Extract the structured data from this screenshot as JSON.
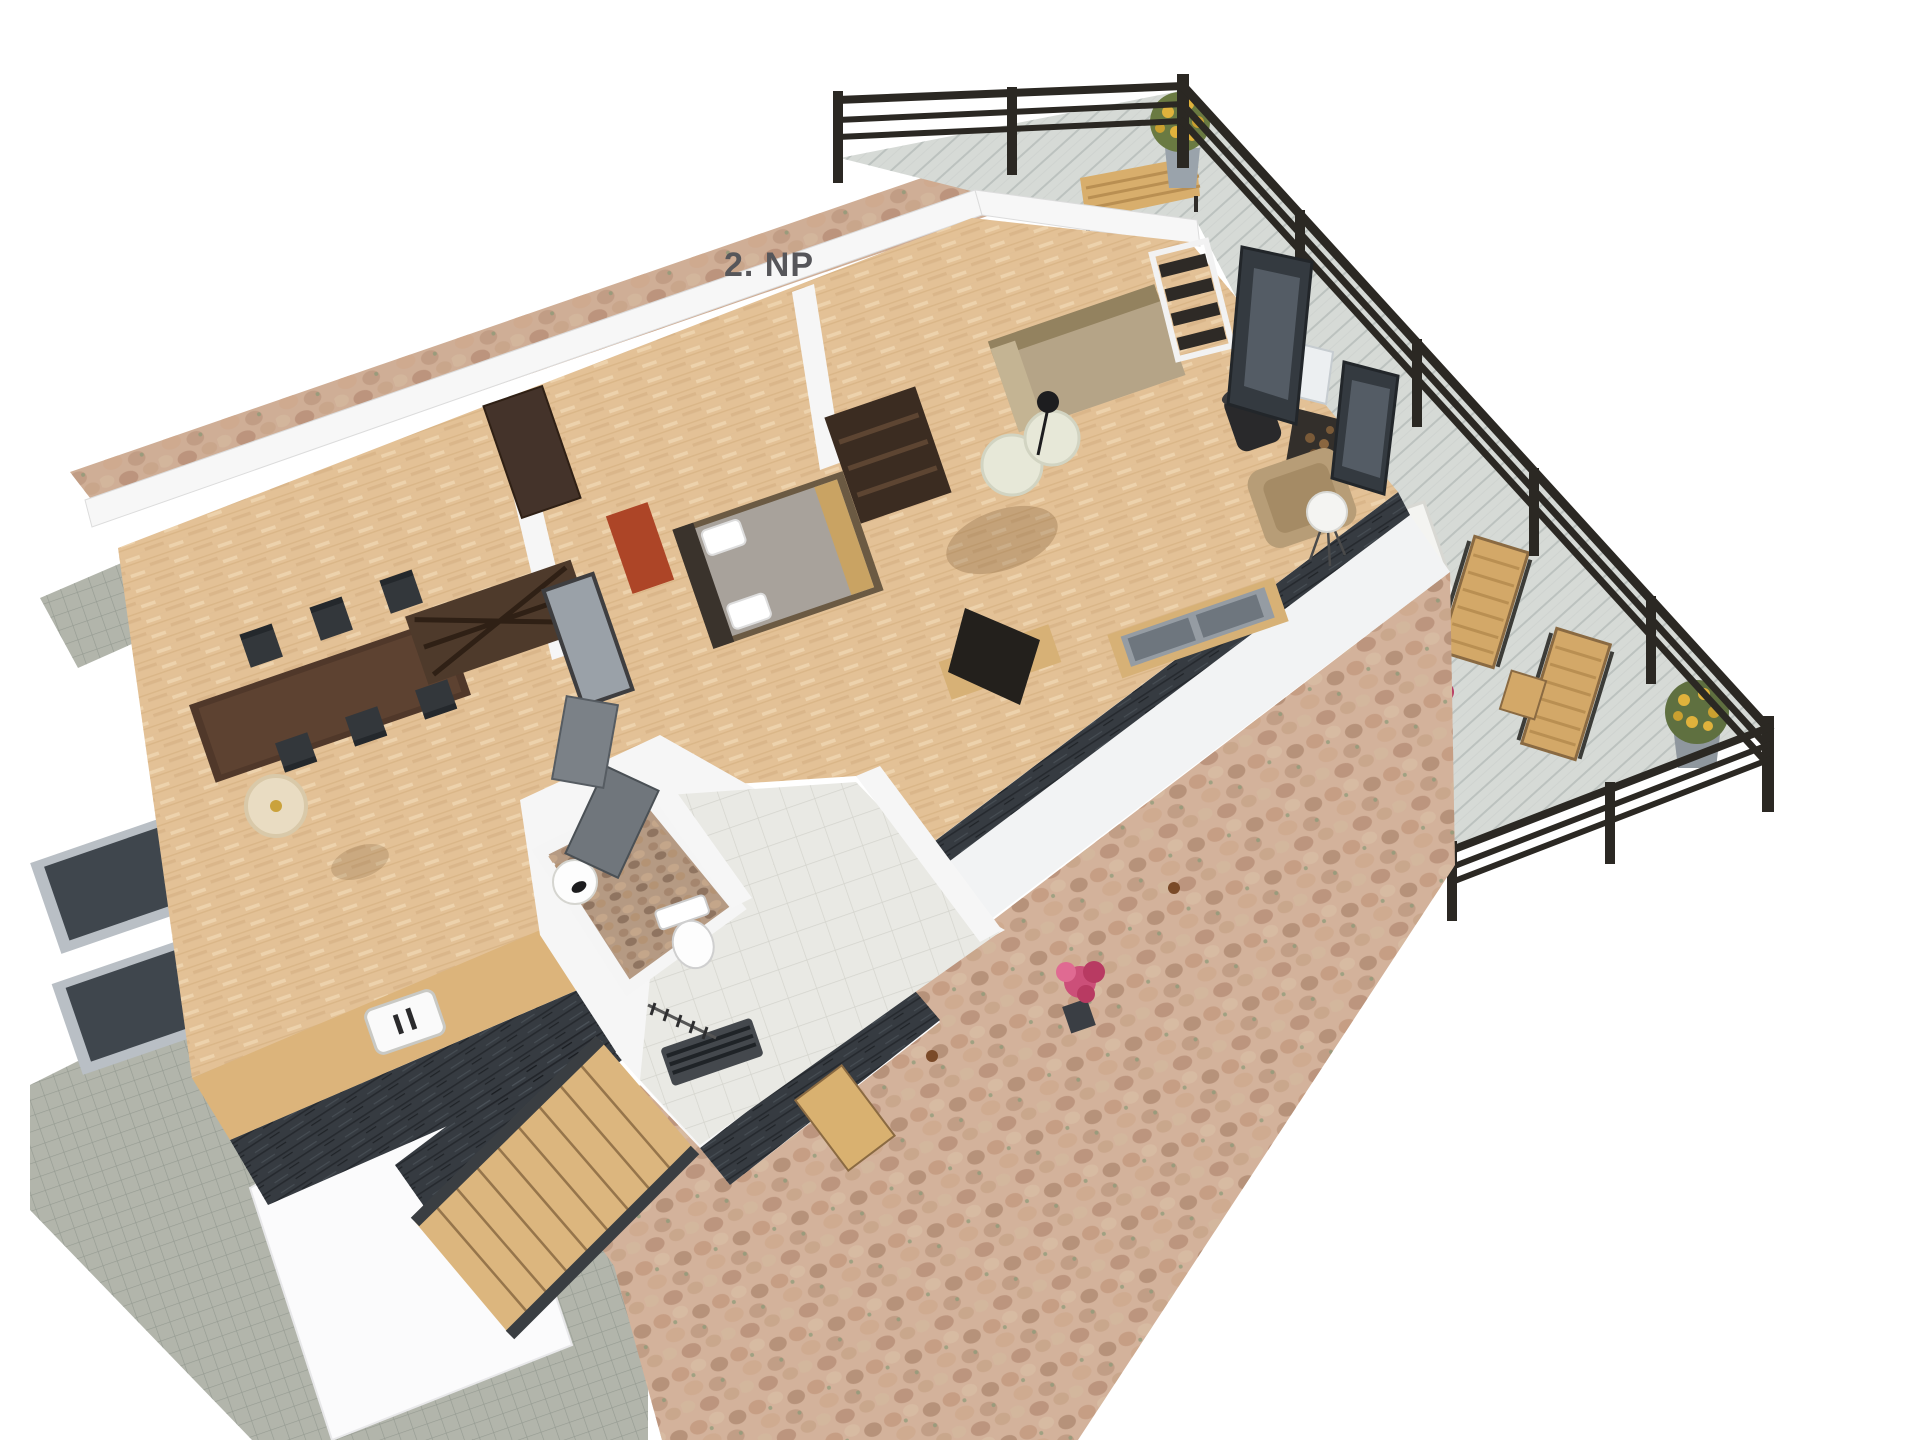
{
  "floor_plan": {
    "label": "2. NP",
    "view": "3d-top-down-render",
    "rooms": [
      "dining-room",
      "bedroom",
      "living-room",
      "bathroom",
      "hallway",
      "staircase",
      "terrace",
      "deck"
    ]
  },
  "colors": {
    "background": "#ffffff",
    "parquet": "#e3c196",
    "deck": "#d6dad6",
    "stone_patio": "#d3b29b",
    "stone_path": "#cfae96",
    "pavers": "#b2b5ab",
    "dark_wall": "#363b41",
    "white_wall": "#f7f7f7",
    "tile_floor": "#e9e9e4",
    "mosaic_floor": "#b59a83",
    "railing": "#2b2823",
    "wood_light": "#d7b176",
    "wood_dark": "#46342a",
    "sofa_beige": "#b5a487",
    "duvet_gray": "#a8a29b",
    "accent_red_wardrobe": "#ad4527",
    "flower_yellow": "#e0b23c",
    "flower_pink": "#cc4f79",
    "label_text": "#56565a"
  },
  "objects": {
    "terrace": [
      "railing",
      "wooden-bench",
      "plant-pot-yellow"
    ],
    "deck": [
      "railing",
      "white-table",
      "lounge-chair",
      "lounge-chair",
      "side-table",
      "flower-pot-yellow",
      "flower-pot-pink"
    ],
    "living_room": [
      "daybed",
      "pouf",
      "pouf",
      "small-lamp",
      "white-ladder-shelf",
      "wood-stove",
      "chimney-box",
      "firewood-rack",
      "armchair",
      "sphere-floor-lamp",
      "tv-stand",
      "tv",
      "sideboard",
      "glass-door",
      "glass-door"
    ],
    "bedroom": [
      "double-bed",
      "pillows",
      "ladder-shelf",
      "red-wardrobe",
      "mirror",
      "console-table",
      "wardrobe"
    ],
    "dining_room": [
      "dining-table",
      "chairs",
      "round-rug",
      "kitchen-counter",
      "sink"
    ],
    "bathroom": [
      "toilet",
      "washbasin",
      "door",
      "towel-radiator",
      "coat-hooks"
    ],
    "exterior": [
      "stone-patio",
      "stone-path",
      "paver-area",
      "roof-window",
      "roof-window",
      "stairs",
      "wall-lamp",
      "flower-bush-pink"
    ]
  }
}
